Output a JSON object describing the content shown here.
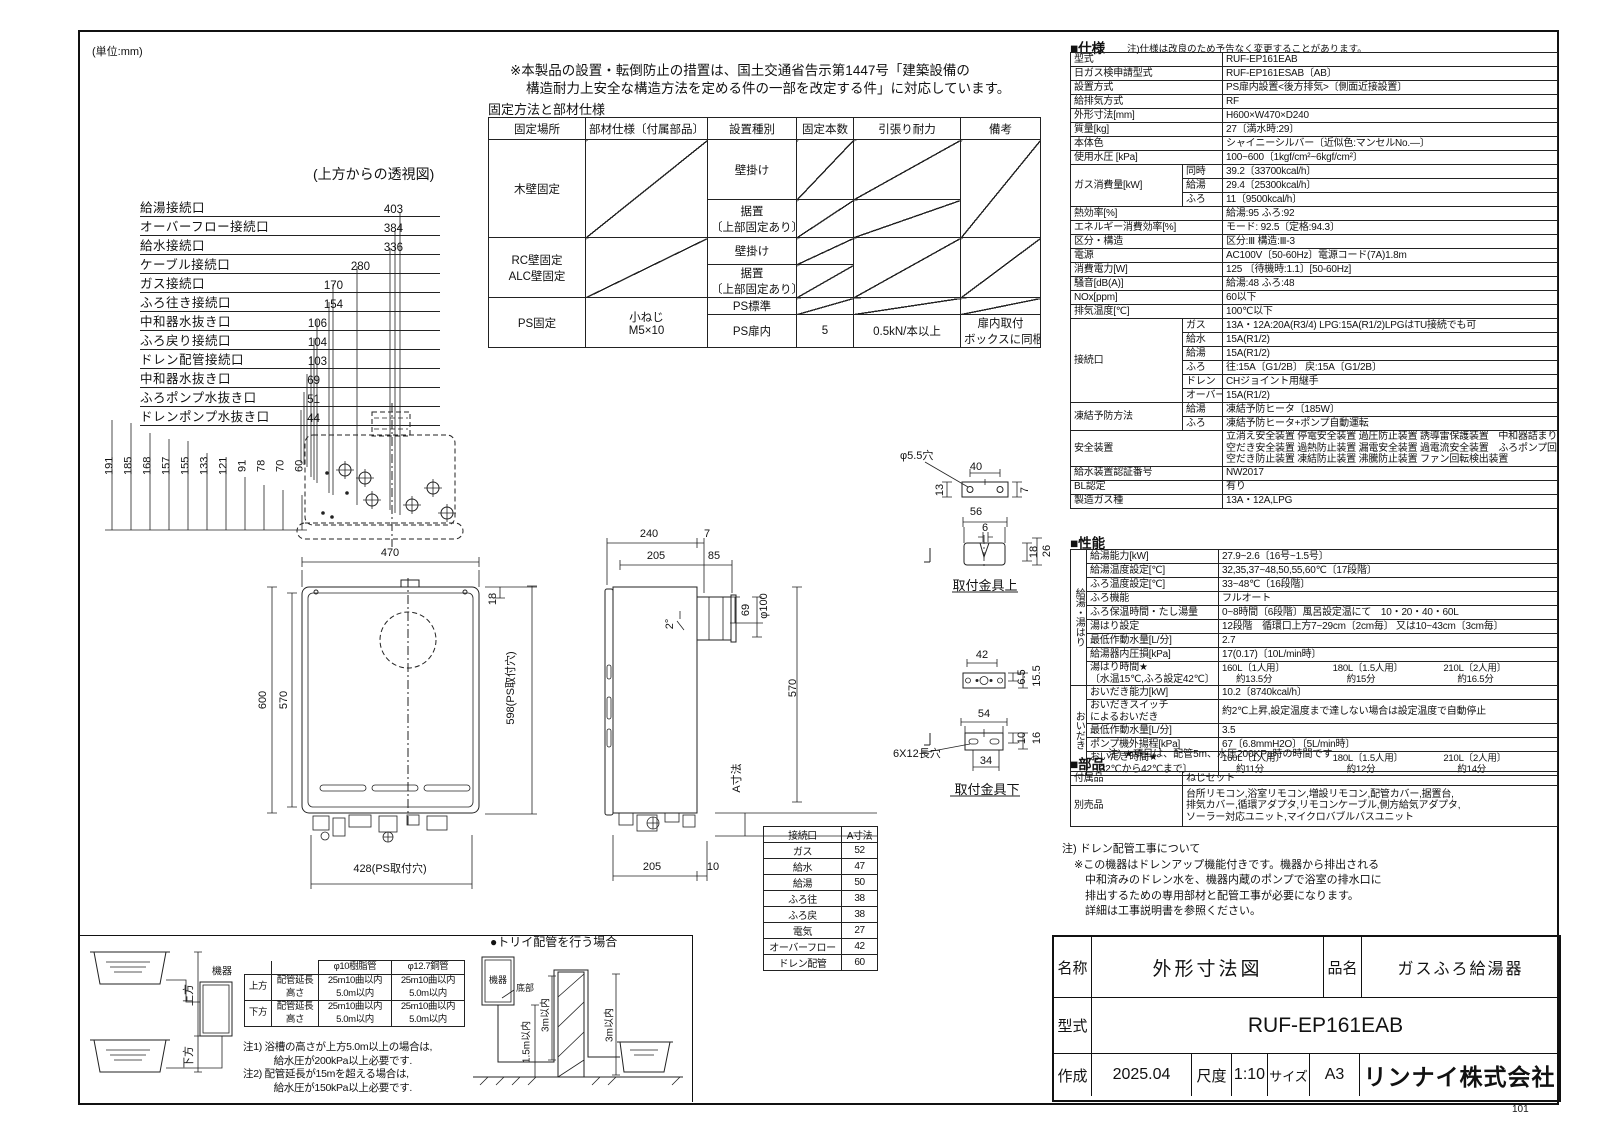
{
  "page": {
    "unit": "(単位:mm)",
    "page_no": "101"
  },
  "top_note": {
    "line1": "※本製品の設置・転倒防止の措置は、国土交通省告示第1447号「建築設備の",
    "line2": "構造耐力上安全な構造方法を定める件の一部を改定する件」に対応しています。"
  },
  "fixing": {
    "title": "固定方法と部材仕様",
    "headers": [
      "固定場所",
      "部材仕様〔付属部品〕",
      "設置種別",
      "固定本数",
      "引張り耐力",
      "備考"
    ],
    "wood": "木壁固定",
    "rc1": "RC壁固定",
    "rc2": "ALC壁固定",
    "ps": "PS固定",
    "screw1": "小ねじ",
    "screw2": "M5×10",
    "wall": "壁掛け",
    "floor1": "据置",
    "floor2": "〔上部固定あり〕",
    "ps_std": "PS標準",
    "ps_door": "PS扉内",
    "count": "5",
    "pull": "0.5kN/本以上",
    "remark1": "扉内取付",
    "remark2": "ボックスに同梱"
  },
  "top_view": {
    "caption": "(上方からの透視図)",
    "ports": [
      {
        "label": "給湯接続口",
        "dim": "403"
      },
      {
        "label": "オーバーフロー接続口",
        "dim": "384"
      },
      {
        "label": "給水接続口",
        "dim": "336"
      },
      {
        "label": "ケーブル接続口",
        "dim": "280"
      },
      {
        "label": "ガス接続口",
        "dim": "170"
      },
      {
        "label": "ふろ往き接続口",
        "dim": "154"
      },
      {
        "label": "中和器水抜き口",
        "dim": "106"
      },
      {
        "label": "ふろ戻り接続口",
        "dim": "104"
      },
      {
        "label": "ドレン配管接続口",
        "dim": "103"
      },
      {
        "label": "中和器水抜き口",
        "dim": "69"
      },
      {
        "label": "ふろポンプ水抜き口",
        "dim": "51"
      },
      {
        "label": "ドレンポンプ水抜き口",
        "dim": "44"
      }
    ],
    "v_dims": [
      "191",
      "185",
      "168",
      "157",
      "155",
      "133",
      "121",
      "91",
      "78",
      "70",
      "60"
    ]
  },
  "front_view": {
    "w": "470",
    "h": "600",
    "h_in": "570",
    "off": "18",
    "ps_v": "598(PS取付穴)",
    "ps_h": "428(PS取付穴)"
  },
  "side_view": {
    "d": "240",
    "d2": "7",
    "d3": "205",
    "d4": "85",
    "angle": "2°",
    "e_off": "69",
    "phi": "φ100",
    "h": "570",
    "a": "A寸法",
    "b1": "205",
    "b2": "10"
  },
  "bracket_top": {
    "caption": "取付金具上",
    "hole": "φ5.5穴",
    "d40": "40",
    "d7": "7",
    "d13": "13",
    "d56": "56",
    "d6": "6",
    "d18": "18",
    "d26": "26"
  },
  "bracket_bot": {
    "caption": "取付金具下",
    "d42": "42",
    "d65": "6.5",
    "d155": "15.5",
    "d54": "54",
    "d10": "10",
    "d16": "16",
    "slot": "6X12長穴",
    "d34": "34"
  },
  "conn_table": {
    "headers": [
      "接続口",
      "A寸法"
    ],
    "rows": [
      {
        "k": "ガス",
        "v": "52"
      },
      {
        "k": "給水",
        "v": "47"
      },
      {
        "k": "給湯",
        "v": "50"
      },
      {
        "k": "ふろ往",
        "v": "38"
      },
      {
        "k": "ふろ戻",
        "v": "38"
      },
      {
        "k": "電気",
        "v": "27"
      },
      {
        "k": "オーバーフロー",
        "v": "42"
      },
      {
        "k": "ドレン配管",
        "v": "60"
      }
    ]
  },
  "spec": {
    "title": "■仕様",
    "note": "注)仕様は改良のため予告なく変更することがあります。",
    "rows1": [
      {
        "k": "型式",
        "v": "RUF-EP161EAB"
      },
      {
        "k": "日ガス検申請型式",
        "v": "RUF-EP161ESAB〔AB〕"
      },
      {
        "k": "設置方式",
        "v": "PS扉内設置<後方排気>〔側面近接設置〕"
      },
      {
        "k": "給排気方式",
        "v": "RF"
      },
      {
        "k": "外形寸法[mm]",
        "v": "H600×W470×D240"
      },
      {
        "k": "質量[kg]",
        "v": "27〔満水時:29〕"
      },
      {
        "k": "本体色",
        "v": "シャイニーシルバー〔近似色:マンセルNo.—〕"
      },
      {
        "k": "使用水圧 [kPa]",
        "v": "100~600〔1kgf/cm²~6kgf/cm²〕"
      }
    ],
    "gas_label": "ガス消費量[kW]",
    "gas": [
      {
        "k": "同時",
        "v": "39.2〔33700kcal/h〕"
      },
      {
        "k": "給湯",
        "v": "29.4〔25300kcal/h〕"
      },
      {
        "k": "ふろ",
        "v": "11〔9500kcal/h〕"
      }
    ],
    "rows2": [
      {
        "k": "熱効率[%]",
        "v": "給湯:95 ふろ:92"
      },
      {
        "k": "エネルギー消費効率[%]",
        "v": "モード: 92.5〔定格:94.3〕"
      },
      {
        "k": "区分・構造",
        "v": "区分:Ⅲ 構造:Ⅲ-3"
      },
      {
        "k": "電源",
        "v": "AC100V〔50-60Hz〕電源コード(7A)1.8m"
      },
      {
        "k": "消費電力[W]",
        "v": "125 〔待機時:1.1〕[50-60Hz]"
      },
      {
        "k": "騒音[dB(A)]",
        "v": "給湯:48 ふろ:48"
      },
      {
        "k": "NOx[ppm]",
        "v": "60以下"
      },
      {
        "k": "排気温度[℃]",
        "v": "100℃以下"
      }
    ],
    "conn_label": "接続口",
    "conn": [
      {
        "k": "ガス",
        "v": "13A・12A:20A(R3/4) LPG:15A(R1/2)LPGはTU接続でも可"
      },
      {
        "k": "給水",
        "v": "15A(R1/2)"
      },
      {
        "k": "給湯",
        "v": "15A(R1/2)"
      },
      {
        "k": "ふろ",
        "v": "往:15A〔G1/2B〕 戻:15A〔G1/2B〕"
      },
      {
        "k": "ドレン",
        "v": "CHジョイント用継手"
      },
      {
        "k": "オーバーフロー",
        "v": "15A(R1/2)"
      }
    ],
    "freeze_label": "凍結予防方法",
    "freeze": [
      {
        "k": "給湯",
        "v": "凍結予防ヒータ〔185W〕"
      },
      {
        "k": "ふろ",
        "v": "凍結予防ヒータ+ポンプ自動運転"
      }
    ],
    "safety_label": "安全装置",
    "safety": [
      "立消え安全装置 停電安全装置 過圧防止装置 誘導雷保護装置　中和器詰まり検知装置",
      "空だき安全装置 過熱防止装置 漏電安全装置 過電流安全装置　ふろポンプ回転検出装置",
      "空だき防止装置 凍結防止装置 沸騰防止装置 ファン回転検出装置"
    ],
    "rows3": [
      {
        "k": "給水装置認証番号",
        "v": "NW2017"
      },
      {
        "k": "BL認定",
        "v": "有り"
      },
      {
        "k": "製造ガス種",
        "v": "13A・12A,LPG"
      }
    ]
  },
  "performance": {
    "title": "■性能",
    "group1": "給湯・湯はり",
    "group2": "おいだき",
    "g1rows": [
      {
        "k": "給湯能力[kW]",
        "v": "27.9~2.6〔16号~1.5号〕"
      },
      {
        "k": "給湯温度設定[℃]",
        "v": "32,35,37~48,50,55,60℃〔17段階〕"
      },
      {
        "k": "ふろ温度設定[℃]",
        "v": "33~48℃〔16段階〕"
      },
      {
        "k": "ふろ機能",
        "v": "フルオート"
      },
      {
        "k": "ふろ保温時間・たし湯量",
        "v": "0~8時間〔6段階〕風呂設定温にて　10・20・40・60L"
      },
      {
        "k": "湯はり設定",
        "v": "12段階　循環口上方7~29cm〔2cm毎〕 又は10~43cm〔3cm毎〕"
      },
      {
        "k": "最低作動水量[L/分]",
        "v": "2.7"
      },
      {
        "k": "給湯器内圧損[kPa]",
        "v": "17(0.17)〔10L/min時〕"
      }
    ],
    "yubari": {
      "k1": "湯はり時間★",
      "k2": "〔水温15℃,ふろ設定42℃〕",
      "cols": [
        "160L〔1人用〕",
        "180L〔1.5人用〕",
        "210L〔2人用〕"
      ],
      "times": [
        "約13.5分",
        "約15分",
        "約16.5分"
      ]
    },
    "oidaki_cap": {
      "k": "おいだき能力[kW]",
      "v": "10.2〔8740kcal/h〕"
    },
    "switch": {
      "k1": "おいだきスイッチ",
      "k2": "によるおいだき",
      "v": "約2℃上昇,設定温度まで達しない場合は設定温度で自動停止"
    },
    "g2rows": [
      {
        "k": "最低作動水量[L/分]",
        "v": "3.5"
      },
      {
        "k": "ポンプ機外揚程[kPa]",
        "v": "67〔6.8mmH2O〕〔5L/min時〕"
      }
    ],
    "oidaki": {
      "k1": "おいだき時間★",
      "k2": "〔32℃から42℃まで〕",
      "cols": [
        "160L〔1人用〕",
        "180L〔1.5人用〕",
        "210L〔2人用〕"
      ],
      "times": [
        "約11分",
        "約12分",
        "約14分"
      ]
    },
    "note": "注) ★項目は、配管5m、水圧200KPa時の時間です"
  },
  "parts": {
    "title": "■部品",
    "accessory_label": "付属品",
    "accessory": "ねじセット",
    "optional_label": "別売品",
    "optional_lines": [
      "台所リモコン,浴室リモコン,増設リモコン,配管カバー,据置台,",
      "排気カバー,循環アダプタ,リモコンケーブル,側方給気アダプタ,",
      "ソーラー対応ユニット,マイクロバブルバスユニット"
    ]
  },
  "drain_note": {
    "title": "注) ドレン配管工事について",
    "lines": [
      "※この機器はドレンアップ機能付きです。機器から排出される",
      "　中和済みのドレン水を、機器内蔵のポンプで浴室の排水口に",
      "　排出するための専用部材と配管工事が必要になります。",
      "　詳細は工事説明書を参照ください。"
    ]
  },
  "bath": {
    "machine": "機器",
    "up": "上方",
    "down": "下方",
    "pipe_table": {
      "col1": "φ10樹脂管",
      "col2": "φ12.7銅管",
      "rows": [
        {
          "pos": "上方",
          "k1": "配管延長",
          "v1a": "25m10曲以内",
          "v1b": "25m10曲以内",
          "k2": "高さ",
          "v2a": "5.0m以内",
          "v2b": "5.0m以内"
        },
        {
          "pos": "下方",
          "k1": "配管延長",
          "v1a": "25m10曲以内",
          "v1b": "25m10曲以内",
          "k2": "高さ",
          "v2a": "5.0m以内",
          "v2b": "5.0m以内"
        }
      ]
    },
    "notes": [
      "注1) 浴槽の高さが上方5.0m以上の場合は,",
      "　　　給水圧が200kPa以上必要です.",
      "注2) 配管延長が15mを超える場合は,",
      "　　　給水圧が150kPa以上必要です."
    ],
    "torii": {
      "caption": "●トリイ配管を行う場合",
      "machine": "機器",
      "bottom": "底部",
      "d1": "1.5m以内",
      "d2": "3m以内",
      "d3": "3m以内"
    }
  },
  "title_block": {
    "name_label": "名称",
    "name": "外形寸法図",
    "product_label": "品名",
    "product": "ガスふろ給湯器",
    "model_label": "型式",
    "model": "RUF-EP161EAB",
    "date_label": "作成",
    "date": "2025.04",
    "scale_label": "尺度",
    "scale": "1:10",
    "size_label": "サイズ",
    "size": "A3",
    "company": "リンナイ株式会社"
  }
}
